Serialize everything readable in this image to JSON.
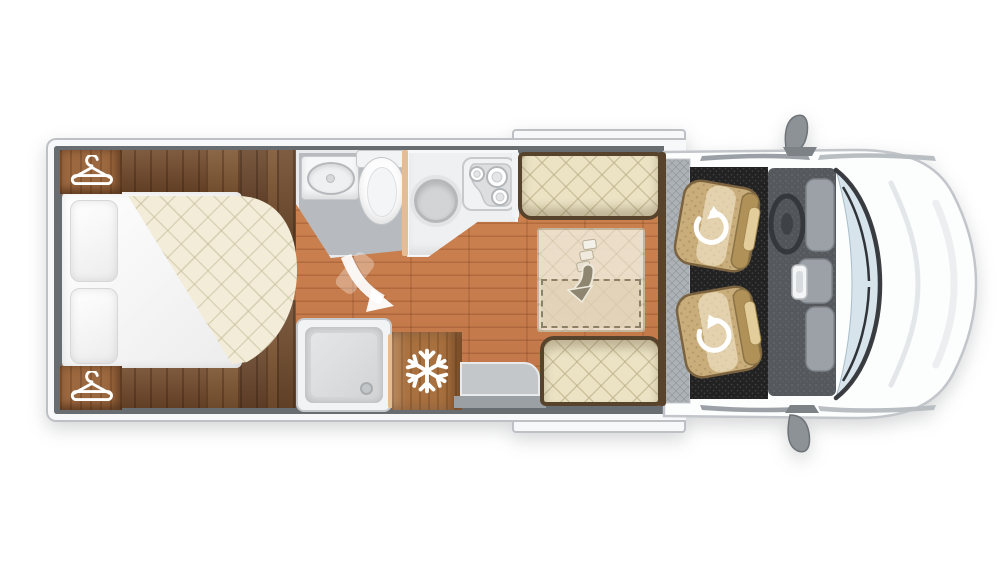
{
  "floorplan": {
    "vehicle": "motorhome top-view floor plan",
    "orientation": "cab on right, rear bedroom on left",
    "areas": {
      "bedroom": {
        "label": "rear bedroom",
        "items": [
          "wardrobe with hanger icon (top)",
          "wardrobe with hanger icon (bottom)",
          "double bed with quilted cream mattress",
          "two pillows",
          "stepped dark-wood bed surround"
        ]
      },
      "washroom": {
        "label": "washroom",
        "items": [
          "basin on counter",
          "toilet"
        ]
      },
      "shower": {
        "label": "shower cubicle",
        "items": [
          "square tray",
          "drain"
        ]
      },
      "kitchen": {
        "label": "kitchen",
        "items": [
          "round sink",
          "three-burner hob"
        ]
      },
      "fridge": {
        "label": "fridge-freezer",
        "items": [
          "snowflake icon"
        ]
      },
      "dinette": {
        "label": "dinette with drop-down bed",
        "items": [
          "front bench seat",
          "rear bench seat",
          "translucent drop-down bed",
          "dashed extension outline",
          "fold-down arrow"
        ]
      },
      "entrance": {
        "label": "entrance step",
        "items": [
          "grey step platform",
          "door swing arrow"
        ]
      },
      "cab": {
        "label": "driver cab",
        "items": [
          "two tan swivel captain seats",
          "swivel rotate arrows",
          "steering wheel",
          "dashboard console",
          "black cab carpet",
          "entry matting",
          "windscreen with wipers",
          "wing mirror top",
          "wing mirror bottom",
          "white bonnet"
        ]
      }
    },
    "icons": {
      "hanger": "white clothes-hanger outline",
      "snowflake": "white six-arm snowflake",
      "swivel": "white circular rotate arrow",
      "fold_down": "grey curved down arrow with segmented tail",
      "door_swing": "white curved swing arrow"
    },
    "colors": {
      "floor_wood": "#c87e4b",
      "cabinet_dark_wood": "#74502f",
      "wardrobe_wood": "#9c683f",
      "fridge_wood": "#a9713f",
      "mattress_cream": "#f2ecd9",
      "cushion_cream": "#ebe3c4",
      "wall_grey": "#686d72",
      "washroom_floor": "#b7bbbf",
      "cab_carpet": "#222222",
      "seat_tan": "#c9ad7a",
      "windscreen_blue": "#d8e4ec",
      "body_white": "#fcfdfd"
    }
  }
}
